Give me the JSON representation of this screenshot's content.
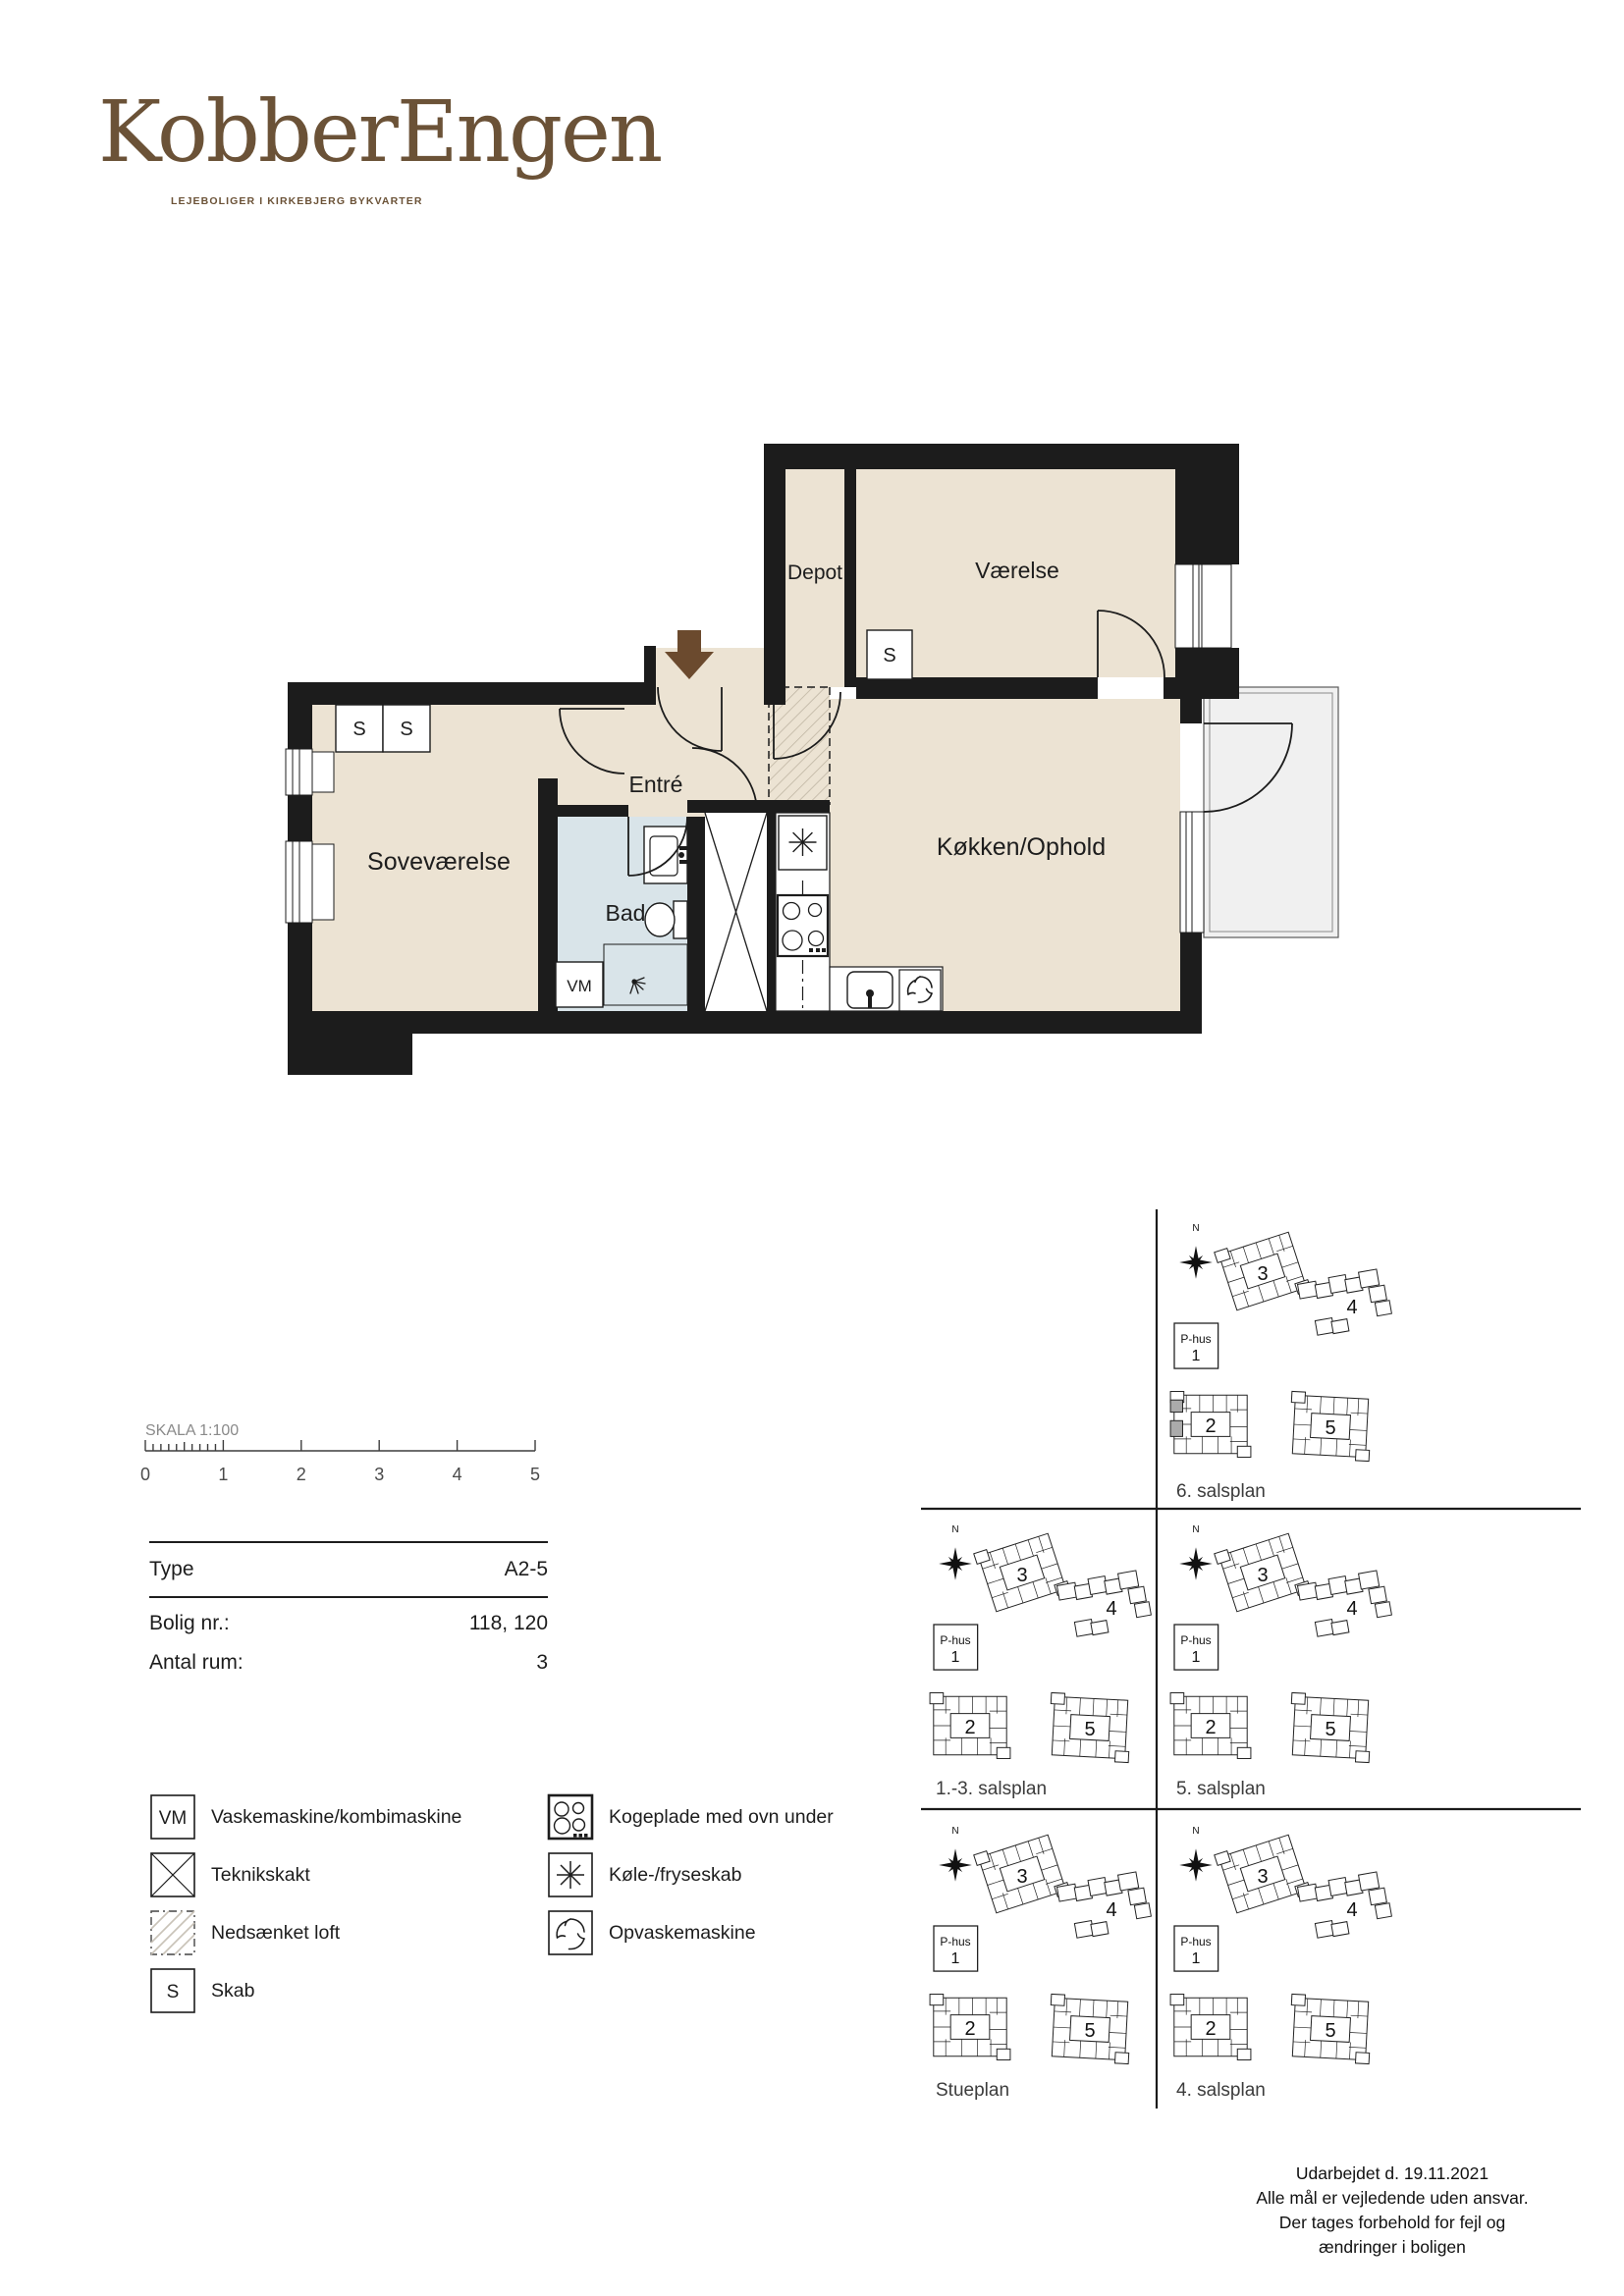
{
  "brand": {
    "name": "KobberEngen",
    "tagline": "LEJEBOLIGER I KIRKEBJERG BYKVARTER",
    "color": "#6B5237"
  },
  "floorplan": {
    "rooms": {
      "depot": "Depot",
      "vaerelse": "Værelse",
      "entre": "Entré",
      "sovevaerelse": "Soveværelse",
      "bad": "Bad",
      "koekken": "Køkken/Ophold"
    },
    "closet": "S",
    "washer": "VM",
    "colors": {
      "wall": "#1C1C1C",
      "room": "#ECE3D3",
      "bath": "#D9E4E9",
      "balcony": "#F0F0F0",
      "entry_arrow": "#6B4A2E"
    }
  },
  "scale": {
    "label": "SKALA 1:100",
    "ticks": [
      "0",
      "1",
      "2",
      "3",
      "4",
      "5"
    ]
  },
  "info_table": {
    "rows": [
      {
        "label": "Type",
        "value": "A2-5"
      },
      {
        "label": "Bolig nr.:",
        "value": "118, 120"
      },
      {
        "label": "Antal rum:",
        "value": "3"
      }
    ]
  },
  "legend": {
    "left": [
      {
        "symbol": "vm",
        "label": "Vaskemaskine/kombimaskine"
      },
      {
        "symbol": "shaft",
        "label": "Teknikskakt"
      },
      {
        "symbol": "ceiling",
        "label": "Nedsænket loft"
      },
      {
        "symbol": "closet",
        "label": "Skab"
      }
    ],
    "right": [
      {
        "symbol": "hob",
        "label": "Kogeplade med ovn under"
      },
      {
        "symbol": "fridge",
        "label": "Køle-/fryseskab"
      },
      {
        "symbol": "dishwasher",
        "label": "Opvaskemaskine"
      }
    ]
  },
  "siteplans": {
    "compass": "N",
    "buildings": {
      "phus": "P-hus",
      "b1": "1",
      "b2": "2",
      "b3": "3",
      "b4": "4",
      "b5": "5"
    },
    "cells": [
      {
        "name": "6. salsplan",
        "col": 1,
        "row": 0,
        "highlight": true
      },
      {
        "name": "1.-3. salsplan",
        "col": 0,
        "row": 1,
        "highlight": false
      },
      {
        "name": "5. salsplan",
        "col": 1,
        "row": 1,
        "highlight": false
      },
      {
        "name": "Stueplan",
        "col": 0,
        "row": 2,
        "highlight": false
      },
      {
        "name": "4. salsplan",
        "col": 1,
        "row": 2,
        "highlight": false
      }
    ]
  },
  "footer": {
    "lines": [
      "Udarbejdet d. 19.11.2021",
      "Alle mål er vejledende uden ansvar.",
      "Der tages forbehold for fejl og",
      "ændringer i boligen"
    ]
  }
}
